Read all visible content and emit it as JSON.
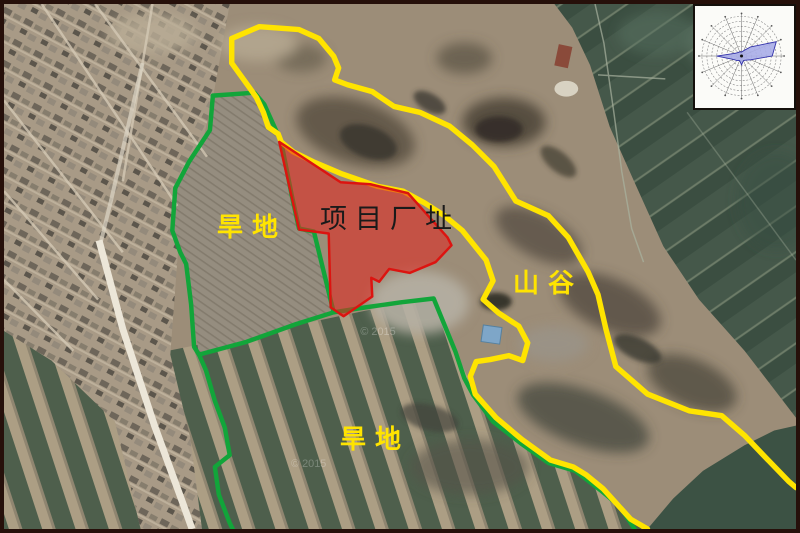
{
  "figure": {
    "type": "satellite-annotation-map",
    "labels": {
      "project_site": "项目厂址",
      "dryland_upper": "旱地",
      "dryland_lower": "旱地",
      "valley": "山谷"
    },
    "watermark": "© 2015",
    "colors": {
      "project_site_fill": "#e6231b",
      "project_site_outline": "#dc1410",
      "farmland_boundary_green": "#12a53a",
      "valley_route_yellow": "#ffe400",
      "label_yellow": "#ffe400",
      "project_label_color": "#1a1a1a",
      "wind_rose_fill": "#a9ade8",
      "wind_rose_outline": "#3333aa"
    },
    "icons": {
      "wind_rose": "wind-rose-diagram"
    }
  }
}
